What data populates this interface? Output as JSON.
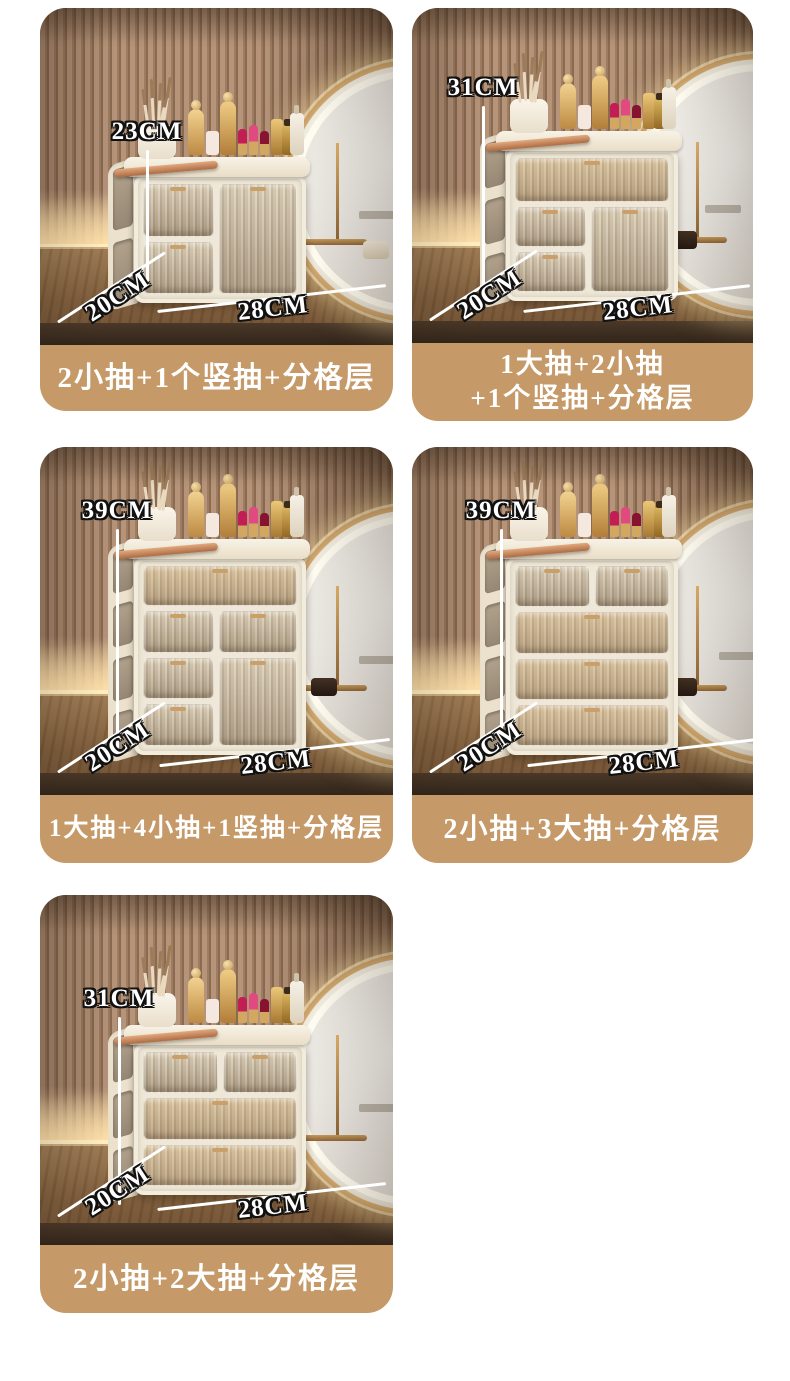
{
  "page": {
    "background": "#ffffff",
    "caption_bg": "#c59a68",
    "caption_text_color": "#ffffff"
  },
  "variants": [
    {
      "name": "variant-23cm",
      "height_label": "23CM",
      "depth_label": "20CM",
      "width_label": "28CM",
      "caption": "2小抽+1个竖抽+分格层"
    },
    {
      "name": "variant-31cm-a",
      "height_label": "31CM",
      "depth_label": "20CM",
      "width_label": "28CM",
      "caption": "1大抽+2小抽\n+1个竖抽+分格层"
    },
    {
      "name": "variant-39cm-a",
      "height_label": "39CM",
      "depth_label": "20CM",
      "width_label": "28CM",
      "caption": "1大抽+4小抽+1竖抽+分格层"
    },
    {
      "name": "variant-39cm-b",
      "height_label": "39CM",
      "depth_label": "20CM",
      "width_label": "28CM",
      "caption": "2小抽+3大抽+分格层"
    },
    {
      "name": "variant-31cm-b",
      "height_label": "31CM",
      "depth_label": "20CM",
      "width_label": "28CM",
      "caption": "2小抽+2大抽+分格层"
    }
  ]
}
